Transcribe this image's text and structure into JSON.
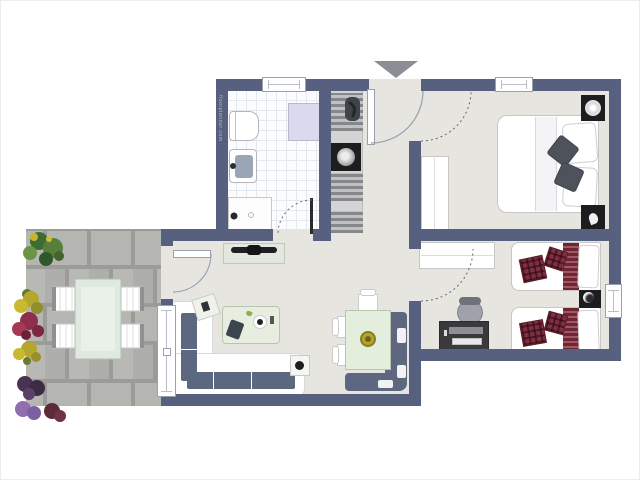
{
  "watermark": {
    "text": "floorplanner.com"
  },
  "colors": {
    "wall": "#57617f",
    "floor": "#e7e5e0",
    "bath_tile": "#fbfcfd",
    "paver": "#b2b3af",
    "paver_joint": "#9b9c98",
    "sofa_cushion": "#5c6880",
    "sage_table": "#e4eedd",
    "maroon_bedding": "#7e3040",
    "black_furniture": "#1c1d1f",
    "lavender_cabinet": "#d9daf0",
    "entrance_marker": "#8b8e95",
    "bowl_olive": "#b4a42e"
  },
  "plan": {
    "entrance": {
      "marker": "down-triangle",
      "door": "entry-door-with-swing"
    },
    "rooms": [
      {
        "name": "bathroom",
        "floor": "white-tile-grid",
        "furniture": [
          "toilet",
          "washbasin",
          "shower",
          "wall-cabinet"
        ],
        "openings": [
          "window-top",
          "door-dashed-swing"
        ]
      },
      {
        "name": "kitchen-strip",
        "furniture": [
          "counter-cabinets",
          "sink-faucet",
          "cooktop-black"
        ]
      },
      {
        "name": "hallway",
        "furniture": []
      },
      {
        "name": "master-bedroom",
        "furniture": [
          "double-bed",
          "white-runner",
          "pillows",
          "dark-throw-pillows",
          "wardrobe",
          "nightstand-lamp",
          "nightstand-plant"
        ],
        "openings": [
          "window-top",
          "door-dashed-swing"
        ]
      },
      {
        "name": "twin-bedroom",
        "furniture": [
          "single-bed-1",
          "single-bed-2",
          "maroon-blankets",
          "maroon-plaid-pillows",
          "nightstand-lamp",
          "wardrobe",
          "desk",
          "office-chair"
        ],
        "openings": [
          "window-right",
          "door-dashed-swing"
        ]
      },
      {
        "name": "living-room",
        "furniture": [
          "tv-sideboard",
          "l-shaped-sofa",
          "coffee-table",
          "corner-side-table",
          "end-table",
          "dining-table",
          "dining-chairs-3",
          "corner-bench",
          "bench-cushions",
          "olive-bowl"
        ],
        "openings": [
          "glass-door-to-terrace",
          "terrace-window"
        ]
      },
      {
        "name": "terrace",
        "floor": "gray-pavers-running-bond",
        "furniture": [
          "outdoor-table",
          "outdoor-chairs-4"
        ],
        "planting": [
          "green-bushes",
          "yellow-flowers",
          "red-flowers",
          "yellow-flowers",
          "dark-purple-planters",
          "lilac-planters"
        ]
      }
    ]
  }
}
